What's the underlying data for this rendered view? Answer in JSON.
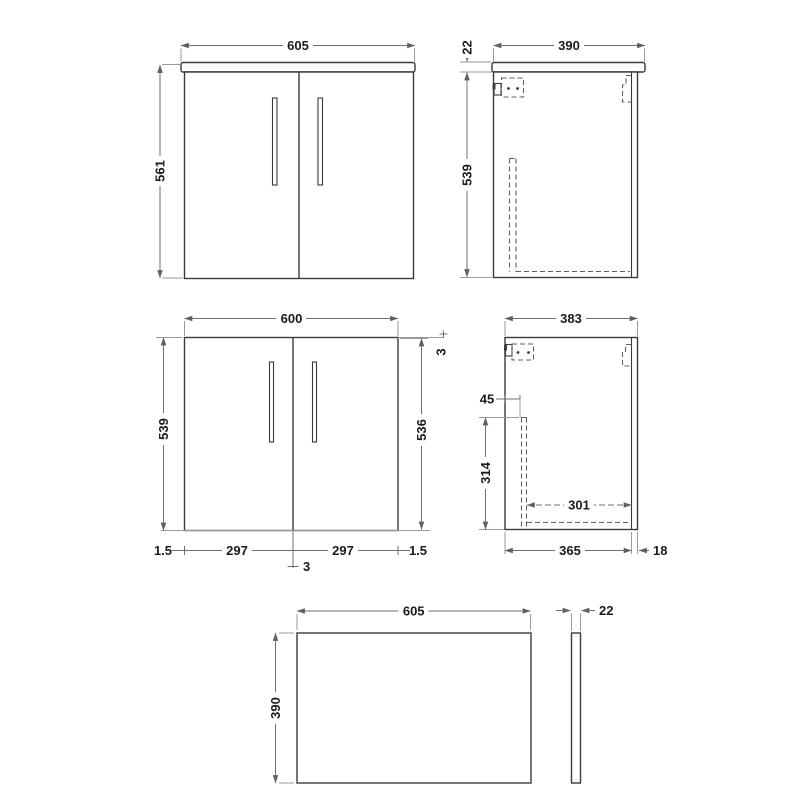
{
  "drawing_type": "vanity-unit-technical-drawing",
  "colors": {
    "background": "#ffffff",
    "outline": "#3a3a3a",
    "dimension_line": "#6f6f6f",
    "hidden_line": "#5f5f5f",
    "text": "#1b1b1b"
  },
  "views": {
    "front_with_worktop": {
      "width": "605",
      "height": "561"
    },
    "side_with_worktop": {
      "depth": "390",
      "worktop_thickness": "22",
      "carcass_height": "539"
    },
    "front_doors": {
      "width": "600",
      "carcass_height": "539",
      "door_height": "536",
      "top_gap": "3",
      "left_edge_gap": "1.5",
      "left_door_width": "297",
      "right_door_width": "297",
      "right_edge_gap": "1.5",
      "center_gap": "3"
    },
    "side_carcass": {
      "depth": "383",
      "back_panel_offset": "45",
      "back_panel_height": "314",
      "internal_depth": "301",
      "carcass_depth": "365",
      "door_thickness": "18"
    },
    "worktop_plan": {
      "width": "605",
      "depth": "390",
      "thickness": "22"
    }
  }
}
